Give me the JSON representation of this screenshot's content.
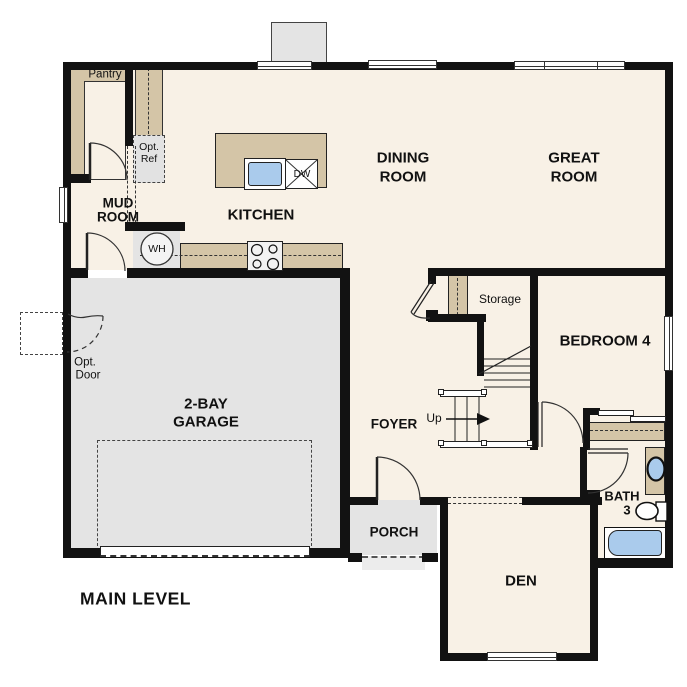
{
  "title": "MAIN LEVEL",
  "colors": {
    "floor": "#f8f1e6",
    "gray": "#e4e4e4",
    "tan": "#d4c5a7",
    "wall": "#121212",
    "fixture_blue": "#aacbec"
  },
  "rooms": {
    "dining": {
      "line1": "DINING",
      "line2": "ROOM"
    },
    "great": {
      "line1": "GREAT",
      "line2": "ROOM"
    },
    "kitchen": {
      "label": "KITCHEN"
    },
    "mud": {
      "line1": "MUD",
      "line2": "ROOM"
    },
    "garage": {
      "line1": "2-BAY",
      "line2": "GARAGE"
    },
    "foyer": {
      "label": "FOYER"
    },
    "bedroom4": {
      "label": "BEDROOM 4"
    },
    "den": {
      "label": "DEN"
    },
    "porch": {
      "label": "PORCH"
    },
    "bath3": {
      "line1": "BATH",
      "line2": "3"
    },
    "storage": {
      "label": "Storage"
    },
    "pantry": {
      "label": "Pantry"
    }
  },
  "annotations": {
    "up": "Up",
    "opt_ref": {
      "line1": "Opt.",
      "line2": "Ref"
    },
    "opt_door": {
      "line1": "Opt.",
      "line2": "Door"
    },
    "water_heater": "WH",
    "dishwasher": "DW",
    "level_title": "MAIN LEVEL"
  }
}
